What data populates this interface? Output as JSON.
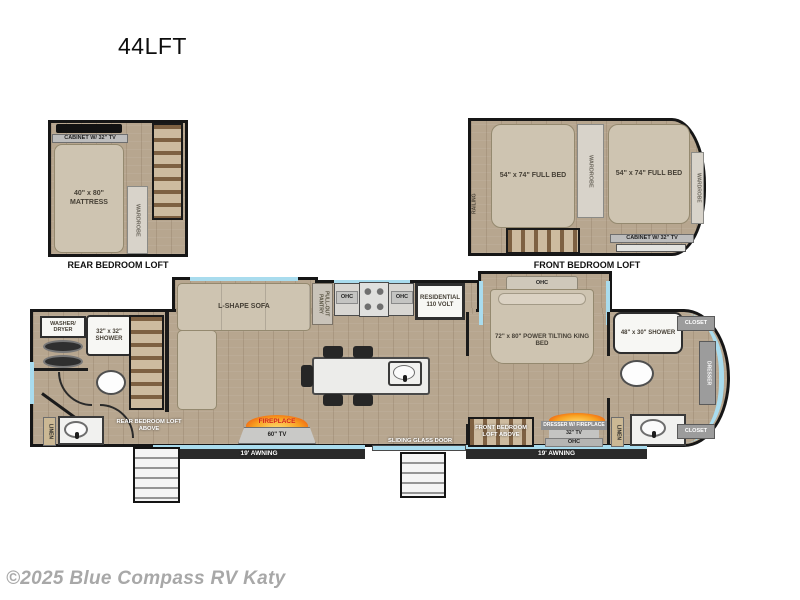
{
  "title": "44LFT",
  "watermark": "©2025 Blue Compass RV Katy",
  "colors": {
    "window": "#a9dcee",
    "wood": "#b7a68f",
    "wall": "#1b1b1b",
    "flame": "#f59b1e",
    "flame_text": "#d21d12"
  },
  "rear_loft": {
    "label": "REAR BEDROOM LOFT",
    "cabinet": "CABINET W/ 32\" TV",
    "mattress": "40\" x 80\" MATTRESS",
    "wardrobe": "WARDROBE"
  },
  "front_loft": {
    "label": "FRONT BEDROOM LOFT",
    "railing": "RAILING",
    "full_bed_left": "54\" x 74\" FULL BED",
    "full_bed_right": "54\" x 74\" FULL BED",
    "wardrobe_center": "WARDROBE",
    "wardrobe_right": "WARDROBE",
    "cabinet": "CABINET W/ 32\" TV"
  },
  "main_floor": {
    "washer_dryer": "WASHER/ DRYER",
    "rear_shower": "32\" x 32\" SHOWER",
    "rear_linen": "LINEN",
    "rear_stairs": "REAR BEDROOM LOFT ABOVE",
    "sofa": "L-SHAPE SOFA",
    "pantry": "PULL-OUT PANTRY",
    "ohc_left": "OHC",
    "ohc_right": "OHC",
    "fridge": "RESIDENTIAL 110 VOLT",
    "fireplace": "FIREPLACE",
    "tv_60": "60\" TV",
    "awning_rear": "19' AWNING",
    "sliding_door": "SLIDING GLASS DOOR",
    "front_stairs": "FRONT BEDROOM LOFT ABOVE",
    "bed_ohc": "OHC",
    "king_bed": "72\" x 80\" POWER TILTING KING BED",
    "dresser_fireplace": "DRESSER W/ FIREPLACE",
    "tv_32": "32\" TV",
    "dresser_ohc": "OHC",
    "awning_front": "19' AWNING",
    "front_linen": "LINEN",
    "front_shower": "48\" x 30\" SHOWER",
    "closet_top": "CLOSET",
    "front_dresser": "DRESSER",
    "closet_bottom": "CLOSET"
  }
}
